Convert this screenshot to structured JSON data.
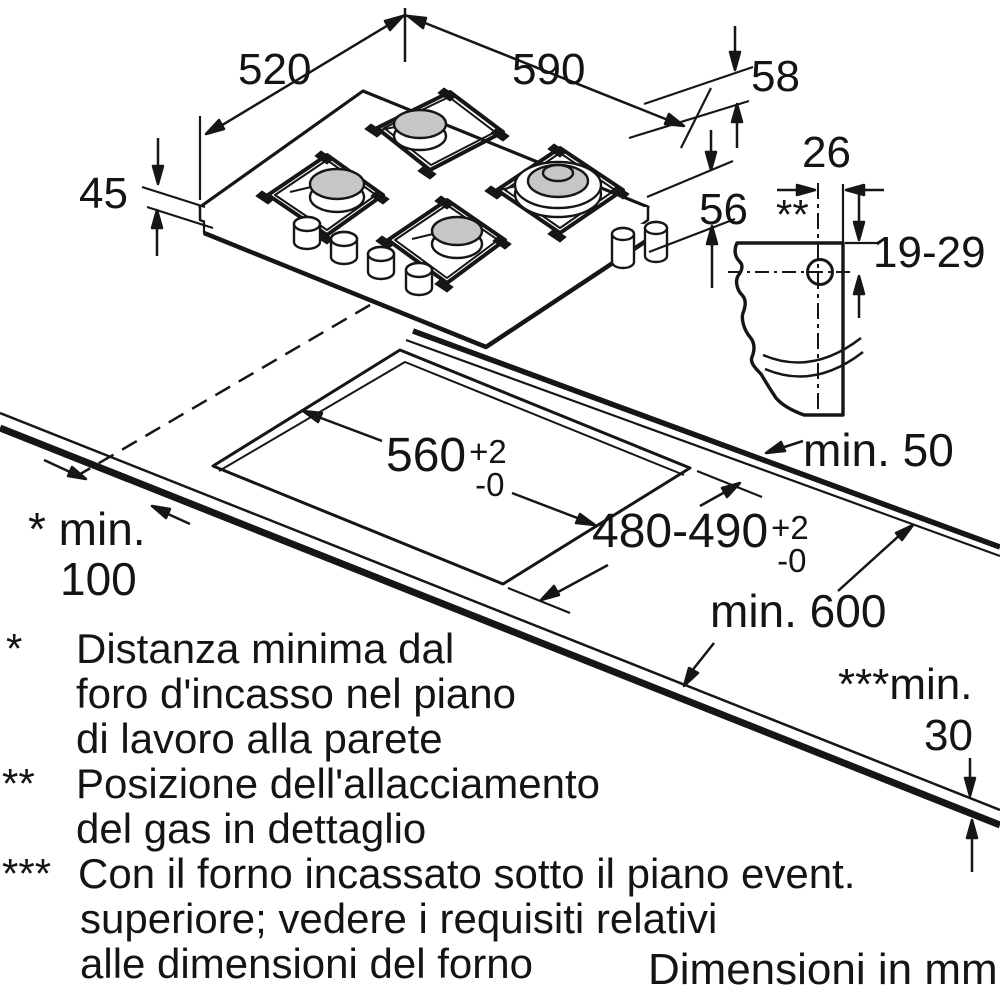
{
  "diagram": {
    "units_note": "Dimensioni in mm",
    "dimensions": {
      "hob_depth": "520",
      "hob_width": "590",
      "edge_height": "58",
      "body_height": "45",
      "install_depth": "56",
      "gas_offset_width": "26",
      "gas_offset_range": "19-29",
      "gas_detail_marker": "**",
      "cutout_width": {
        "value": "560",
        "tol_plus": "+2",
        "tol_minus": "-0"
      },
      "cutout_depth": {
        "value": "480-490",
        "tol_plus": "+2",
        "tol_minus": "-0"
      },
      "min_back_clearance": "min. 50",
      "min_worktop_depth": "min. 600",
      "min_wall_line1": "* min.",
      "min_wall_line2": "100",
      "min_oven_gap_line1": "***min.",
      "min_oven_gap_line2": "30"
    },
    "footnotes": [
      {
        "marker": "*",
        "lines": [
          "Distanza minima dal",
          "foro d'incasso nel piano",
          "di lavoro alla parete"
        ]
      },
      {
        "marker": "**",
        "lines": [
          "Posizione dell'allacciamento",
          "del gas in dettaglio"
        ]
      },
      {
        "marker": "***",
        "lines": [
          "Con il forno incassato sotto il piano event.",
          "superiore; vedere i requisiti relativi",
          "alle dimensioni del forno"
        ]
      }
    ]
  }
}
